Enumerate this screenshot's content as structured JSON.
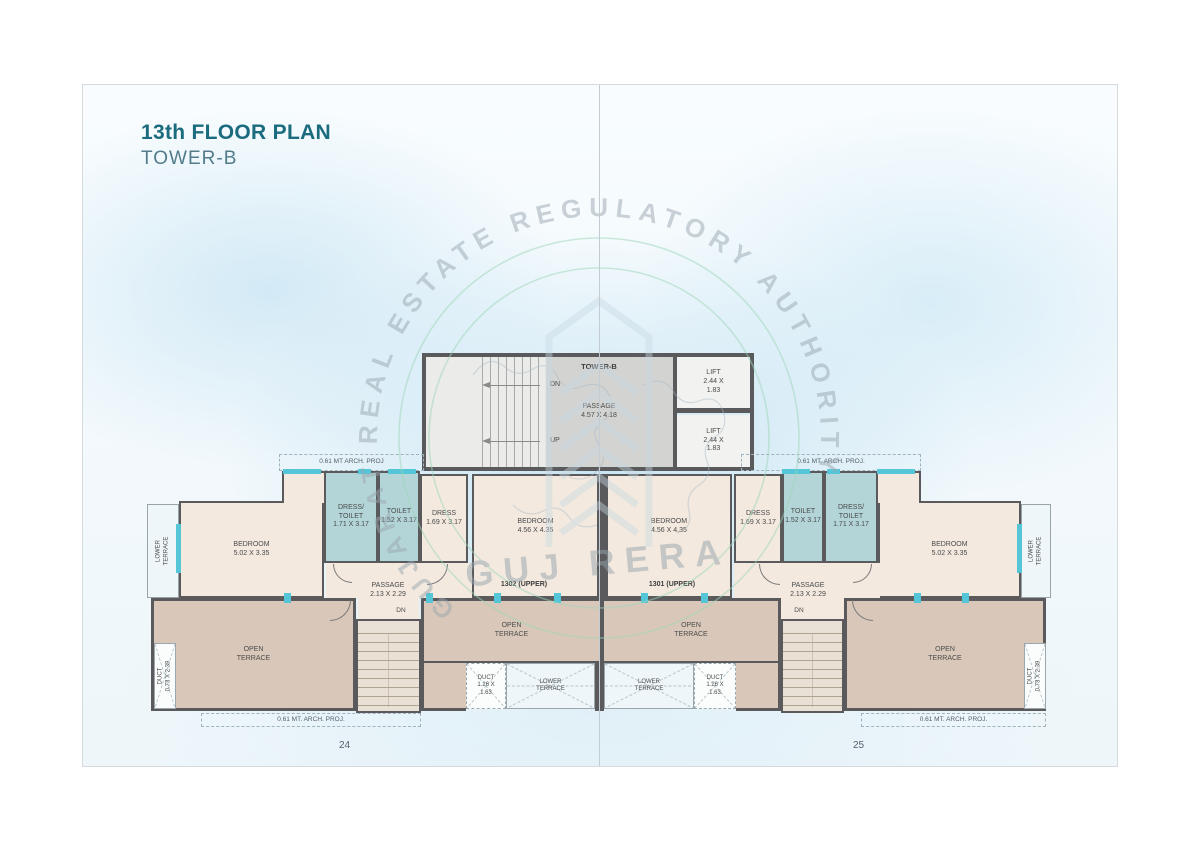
{
  "title": {
    "heading": "13th FLOOR PLAN",
    "subheading": "TOWER-B"
  },
  "pages": {
    "left_number": "24",
    "right_number": "25"
  },
  "core": {
    "tower_label": "TOWER-B",
    "passage": "PASSAGE\n4.57 X 4.18",
    "dn": "DN",
    "up": "UP",
    "lift_top": "LIFT\n2.44 X\n1.83",
    "lift_bottom": "LIFT\n2.44 X\n1.83"
  },
  "arch": {
    "top_left": "0.61 MT ARCH. PROJ",
    "top_right": "0.61 MT. ARCH. PROJ.",
    "bottom_left": "0.61 MT. ARCH. PROJ.",
    "bottom_right": "0.61 MT. ARCH. PROJ."
  },
  "unit_left": {
    "unit_label": "1302 (UPPER)",
    "lower_terrace_side": "LOWER\nTERRACE",
    "bedroom_small": "BEDROOM\n5.02 X 3.35",
    "dress_toilet": "DRESS/\nTOILET\n1.71 X 3.17",
    "toilet": "TOILET\n1.52 X 3.17",
    "dress": "DRESS\n1.69 X 3.17",
    "bedroom_large": "BEDROOM\n4.56 X 4.35",
    "passage": "PASSAGE\n2.13 X 2.29",
    "dn": "DN",
    "open_terrace_outer": "OPEN\nTERRACE",
    "open_terrace_inner": "OPEN\nTERRACE",
    "duct_small": "DUCT\n1.26 X\n1.63",
    "duct_tall": "DUCT\n0.73 X 2.39",
    "lower_terrace_center": "LOWER\nTERRACE"
  },
  "unit_right": {
    "unit_label": "1301 (UPPER)",
    "lower_terrace_side": "LOWER\nTERRACE",
    "bedroom_small": "BEDROOM\n5.02 X 3.35",
    "dress_toilet": "DRESS/\nTOILET\n1.71 X 3.17",
    "toilet": "TOILET\n1.52 X 3.17",
    "dress": "DRESS\n1.69 X 3.17",
    "bedroom_large": "BEDROOM\n4.56 X 4.35",
    "passage": "PASSAGE\n2.13 X 2.29",
    "dn": "DN",
    "open_terrace_outer": "OPEN\nTERRACE",
    "open_terrace_inner": "OPEN\nTERRACE",
    "duct_small": "DUCT\n1.26 X\n1.63",
    "duct_tall": "DUCT\n0.73 X 2.39",
    "lower_terrace_center": "LOWER\nTERRACE"
  },
  "watermark": {
    "arc_text": "GUJARAT REAL ESTATE REGULATORY AUTHORITY",
    "brand": "GUJ RERA"
  },
  "colors": {
    "accent_teal": "#1b6b7e",
    "subtitle_teal": "#527c8a",
    "wall": "#5a5a5c",
    "room_cream": "#f3e9df",
    "room_teal": "#b3d5d8",
    "terrace_tan": "#d9c8b9",
    "window_cyan": "#54c6d8",
    "watermark_green": "#9ed6b8",
    "watermark_gray": "#9aa7b0"
  }
}
